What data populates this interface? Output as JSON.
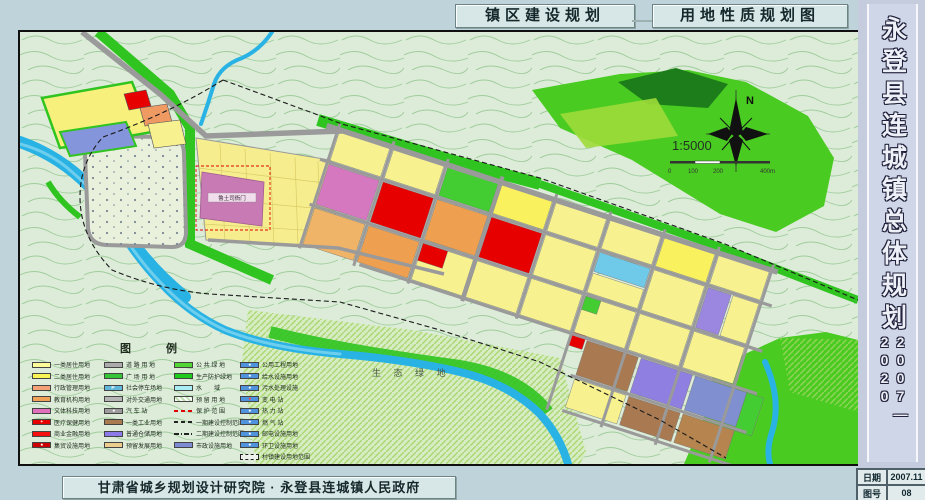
{
  "titles": {
    "left": "镇区建设规划",
    "right": "用地性质规划图"
  },
  "sidebar": {
    "title": "永登县连城镇总体规划",
    "years": "2007—2020",
    "date_label": "日期",
    "date_value": "2007.11",
    "sheet_label": "图号",
    "sheet_value": "08"
  },
  "credit": "甘肃省城乡规划设计研究院 · 永登县连城镇人民政府",
  "map": {
    "labels": {
      "yamen": "鲁土司衙门",
      "eco": "生 态 绿 地",
      "north": "N",
      "scale": "1:5000"
    },
    "scalebar": [
      "0",
      "100",
      "200",
      "400m"
    ],
    "legend": {
      "title": "图 例",
      "columns": [
        [
          {
            "label": "一类居住用地",
            "fill": "#fdfa9a"
          },
          {
            "label": "二类居住用地",
            "fill": "#fbf455"
          },
          {
            "label": "行政管理用地",
            "fill": "#f2a276"
          },
          {
            "label": "教育机构用地",
            "fill": "#efa257"
          },
          {
            "label": "文体科技用地",
            "fill": "#e070bc"
          },
          {
            "label": "医疗保健用地",
            "fill": "#e60000",
            "type": "icon",
            "glyph": "+"
          },
          {
            "label": "商业金融用地",
            "fill": "#f50f0f"
          },
          {
            "label": "集贸设施用地",
            "fill": "#cc0202",
            "type": "icon",
            "glyph": "●"
          }
        ],
        [
          {
            "label": "道 路 用 地",
            "fill": "#ababab"
          },
          {
            "label": "广 场 用 地",
            "fill": "#35c435"
          },
          {
            "label": "社会停车场地",
            "fill": "#5fb8dc",
            "type": "icon",
            "glyph": "P"
          },
          {
            "label": "对外交通用地",
            "fill": "#b5b5b5"
          },
          {
            "label": "汽 车 站",
            "fill": "#9d9d9d",
            "type": "icon",
            "glyph": "●"
          },
          {
            "label": "一类工业用地",
            "fill": "#aa7a50"
          },
          {
            "label": "普通仓储用地",
            "fill": "#8b7ae8"
          },
          {
            "label": "预留发展用地",
            "fill": "#eccf8d"
          }
        ],
        [
          {
            "label": "公 共 绿 地",
            "fill": "#52d634"
          },
          {
            "label": "生产防护绿地",
            "fill": "#1fca1f"
          },
          {
            "label": "水　　域",
            "fill": "#a8ecf4"
          },
          {
            "label": "预 留 用 地",
            "type": "hatch"
          },
          {
            "label": "保 护 范 围",
            "type": "line-red-dash"
          },
          {
            "label": "一期建设控制范围",
            "type": "line-dash"
          },
          {
            "label": "二期建设控制范围",
            "type": "line-dashdot"
          },
          {
            "label": "市政设施用地",
            "fill": "#7d8cd2"
          }
        ],
        [
          {
            "label": "公用工程用地",
            "fill": "#4f93dc",
            "type": "icon",
            "glyph": "●"
          },
          {
            "label": "给水设施用地",
            "fill": "#4f93dc",
            "type": "icon",
            "glyph": "●"
          },
          {
            "label": "污水处理设施",
            "fill": "#4f93dc",
            "type": "icon",
            "glyph": "●"
          },
          {
            "label": "变 电 站",
            "fill": "#4f93dc",
            "type": "icon",
            "glyph": "●",
            "glyphColor": "#ff4040"
          },
          {
            "label": "热 力 站",
            "fill": "#4f93dc",
            "type": "icon",
            "glyph": "●"
          },
          {
            "label": "燃 气 站",
            "fill": "#4f93dc",
            "type": "icon",
            "glyph": "●"
          },
          {
            "label": "邮电设施用地",
            "fill": "#4f93dc",
            "type": "icon",
            "glyph": "●"
          },
          {
            "label": "环卫设施用地",
            "fill": "#4f93dc",
            "type": "icon",
            "glyph": "●"
          },
          {
            "label": "村镇建设用地范围",
            "type": "dashbox"
          }
        ]
      ]
    }
  },
  "colors": {
    "page_bg": "#bfd3da",
    "map_bg": "#dcecd8",
    "river": "#29b2e4",
    "green": "#49cb21",
    "road": "#9a9a9a",
    "residential": "#f7f18f",
    "commercial_red": "#e60000",
    "yamen_pink": "#c87ab4"
  }
}
